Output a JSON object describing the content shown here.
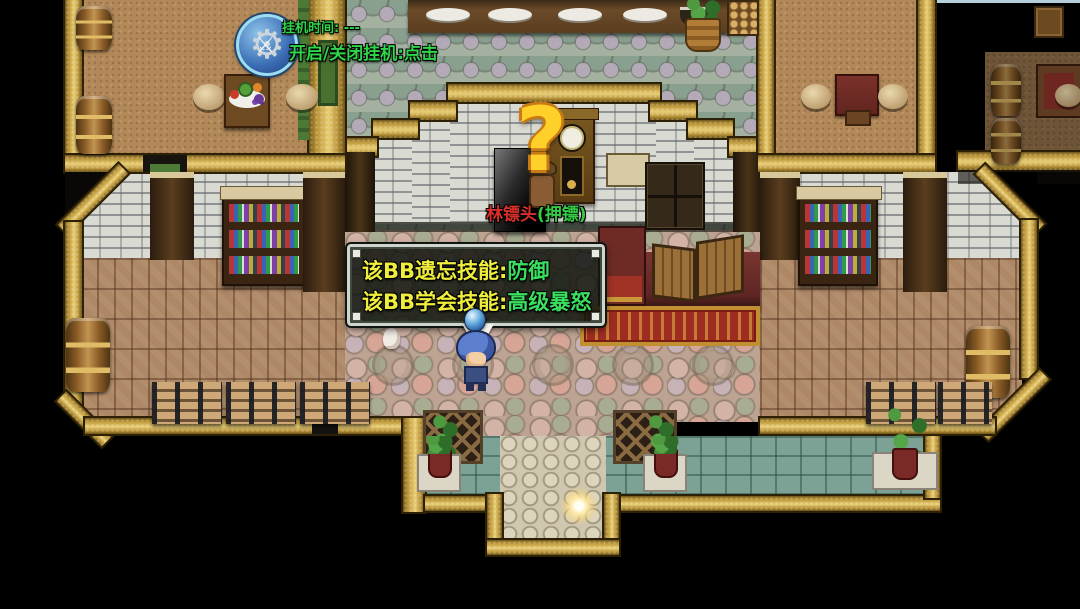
{
  "ui": {
    "idle_widget": {
      "icon": "gear-swords-icon",
      "timer_label": "挂机时间: ---",
      "toggle_label": "开启/关闭挂机:点击",
      "text_color": "#2fd649"
    },
    "npc": {
      "emote": "?",
      "emote_color": "#ffcf2a",
      "name": "林镖头",
      "role": "(押镖)",
      "name_color": "#d83028",
      "role_color": "#33cc44"
    },
    "dialog": {
      "lines": [
        {
          "label": "该BB遗忘技能:",
          "value": "防御"
        },
        {
          "label": "该BB学会技能:",
          "value": "高级暴怒"
        }
      ],
      "label_color": "#f0ee3c",
      "value_color": "#3bdf5f",
      "pause_indicator": "blue-orb"
    },
    "player": {
      "sprite": "blue-haired-hero"
    }
  },
  "scene": {
    "type": "rpg-inn-interior",
    "accent_colors": {
      "wall_gold": "#ddbd60",
      "carpet_red": "#9e2c20",
      "floor_brick": "#ad8766",
      "cobble_pink": "#bda391",
      "cobble_gray": "#9cab9c",
      "green_tile": "#7ca295"
    }
  }
}
